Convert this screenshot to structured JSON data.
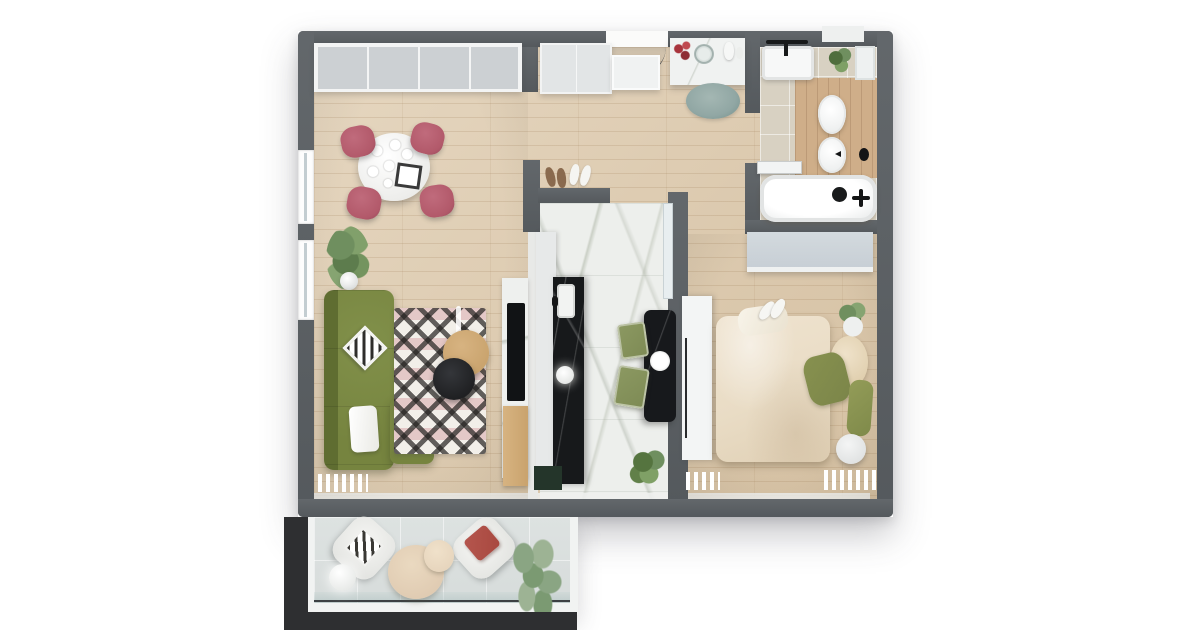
{
  "meta": {
    "title": "3D apartment floor plan - top-down architectural render",
    "description": "Photorealistic top view of a one-bedroom apartment with balcony; no visible text labels in the image"
  },
  "palette": {
    "background": "#ffffff",
    "wall": "#595e62",
    "wood_floor": "#ddc9ab",
    "marble_floor": "#edefec",
    "tile_floor": "#d8d1c2",
    "bath_wood": "#cfae89",
    "balcony_tile": "#d7dcdb",
    "shadow_block": "#2e2f31",
    "cabinet_gray": "#ccd0d3",
    "sofa_green": "#76843f",
    "sofa_green_dark": "#5f6d31",
    "chair_pink": "#b2596a",
    "rug_base": "#f2efe9",
    "coffee_wood": "#c9a36d",
    "tray_black": "#1f2022",
    "counter_black": "#17191b",
    "counter_white": "#e7e9e9",
    "cabinet_green": "#24352a",
    "kitchen_chair_green": "#7e8b55",
    "bed_beige": "#e9dcc5",
    "pillow_green": "#7b8549",
    "wardrobe_gray": "#c6cdd4",
    "rug_teal": "#91a7a4",
    "plant_green": "#6f8f5f",
    "plant_light": "#8aa583",
    "accent_red": "#a8343c",
    "red_pillow": "#a8483f",
    "fixture_white": "#f7f8f8"
  },
  "rooms": {
    "living_dining": {
      "label": "living-dining-room",
      "floor": "light oak plank",
      "items": {
        "closets": "built-in closet row",
        "table": "round dining table for four",
        "chairs": "four pink velvet dining chairs",
        "plant": "potted plant",
        "lamp": "floor lamp with black side table",
        "sofa": "green corner sofa",
        "rug": "black-white-pink patterned rug",
        "coffee_table": "round wood coffee table",
        "tray": "round black tray table",
        "tv_wall": "marble media wall with TV"
      }
    },
    "kitchen": {
      "label": "kitchen",
      "floor": "white marble",
      "items": {
        "counter": "counter run with black marble worktop and sink",
        "pendant": "pendant light",
        "table": "black breakfast table",
        "chairs": "two green chairs",
        "plant": "potted plant",
        "base_cabinet": "dark green base cabinet"
      }
    },
    "entrance": {
      "label": "entrance-hall",
      "floor": "light oak plank",
      "items": {
        "door": "entrance door with swing arc",
        "shoe_cabinet": "shoe cabinet",
        "console": "marble console with decor",
        "rug": "round teal rug",
        "slippers": "two pairs of slippers"
      }
    },
    "bedroom": {
      "label": "bedroom",
      "floor": "light oak plank",
      "items": {
        "wardrobe": "gray wardrobe",
        "closet": "tall white closet",
        "bed": "double bed with beige duvet and green pillows",
        "side_table": "round side table",
        "plant": "potted plant",
        "rug": "white fringed rug"
      }
    },
    "bathroom": {
      "label": "bathroom",
      "floor": "beige tile with wood platform",
      "items": {
        "vanity": "vanity sink with black faucet",
        "toilet": "toilet",
        "bidet": "bidet",
        "tub": "bathtub with black fittings",
        "shelf": "storage shelf",
        "plant": "potted plant",
        "door": "open door leaf"
      }
    },
    "balcony": {
      "label": "balcony",
      "floor": "gray tile with glass railing",
      "items": {
        "chair_1": "lounge chair with diamond pillow",
        "chair_2": "lounge chair with red pillow",
        "tables": "two round coffee tables",
        "lamp": "white sphere lamp",
        "plant": "trailing plant"
      }
    }
  }
}
